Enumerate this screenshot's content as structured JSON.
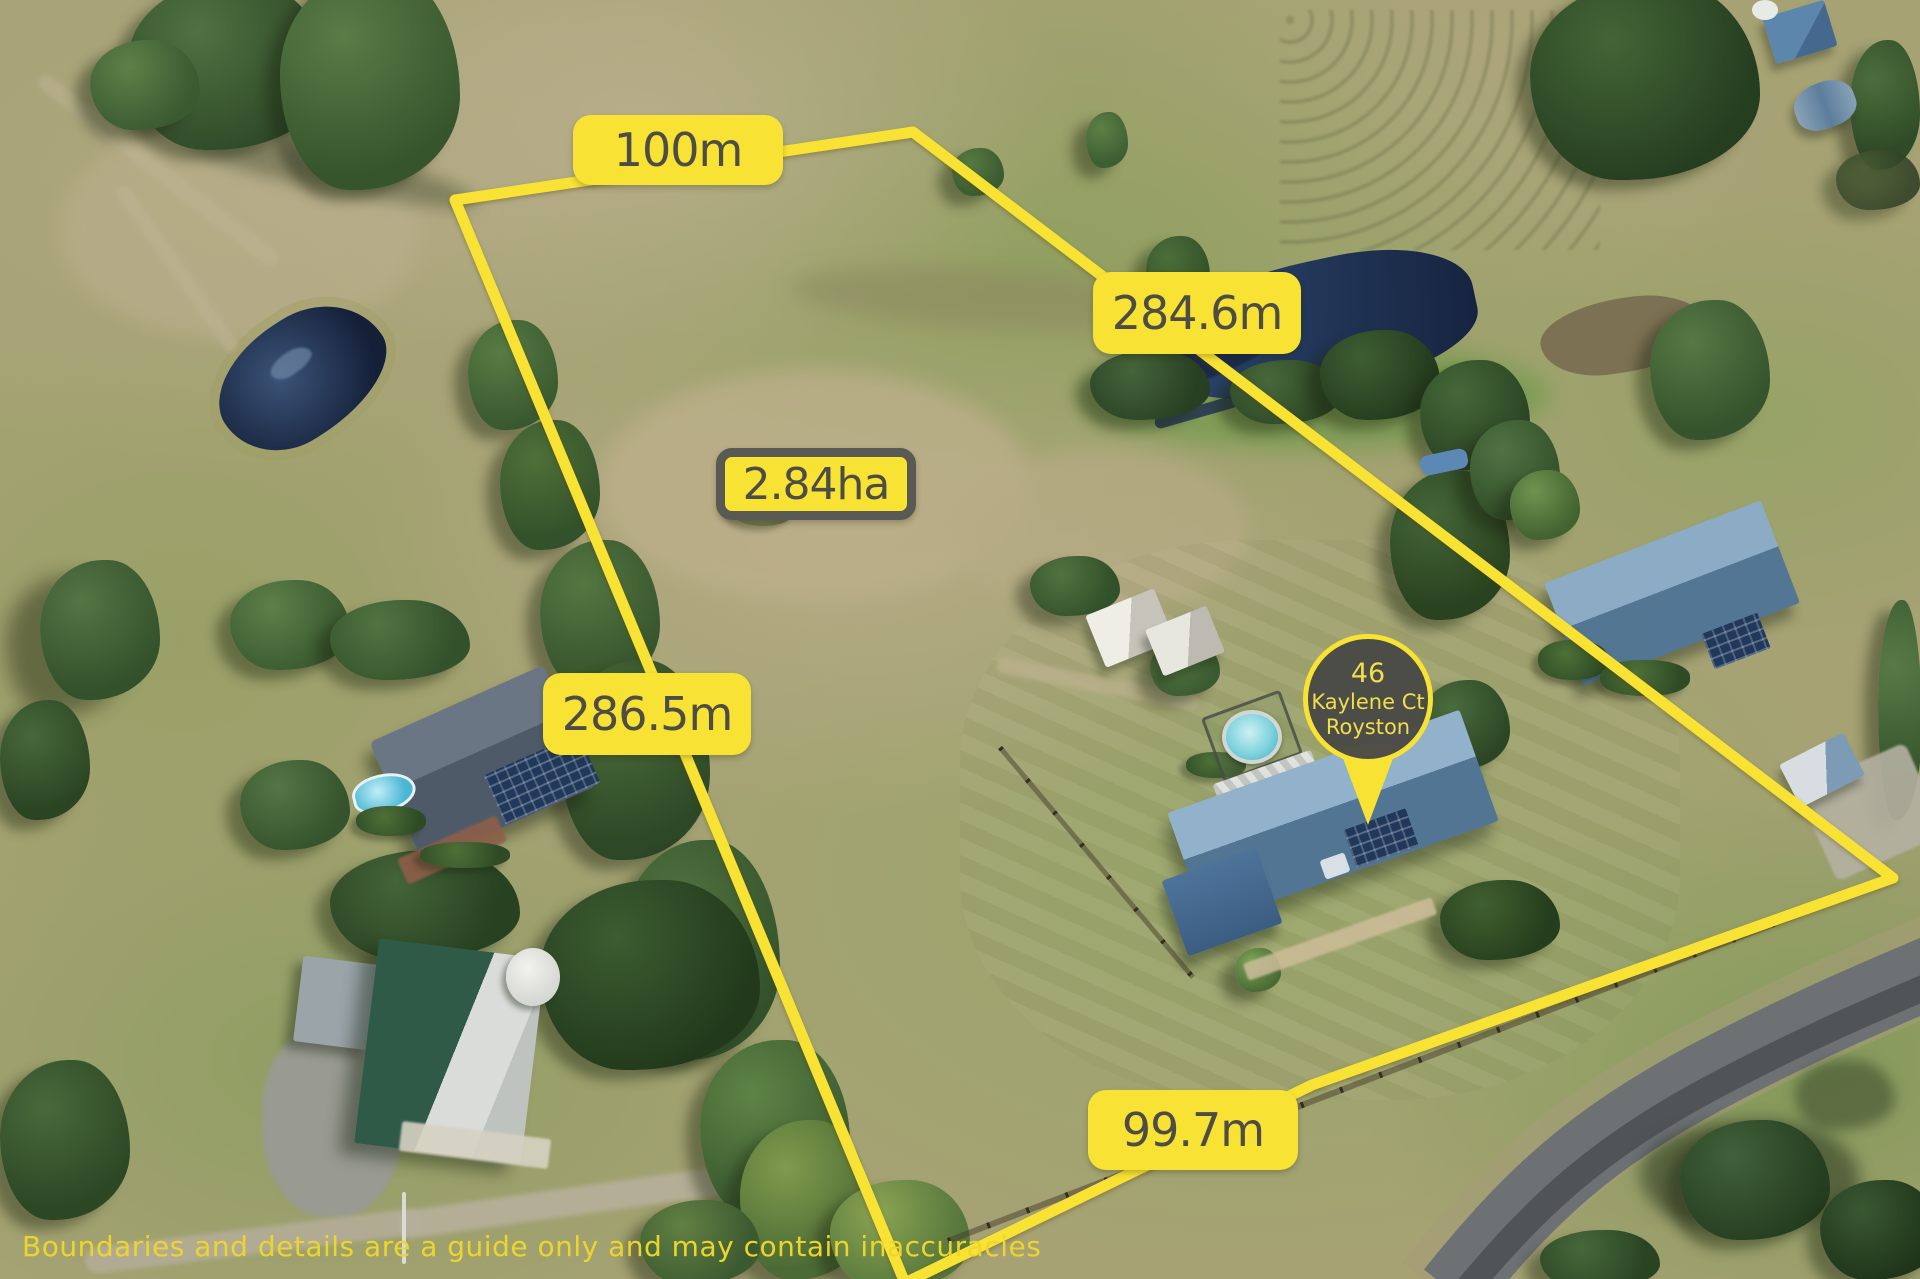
{
  "scene": {
    "description": "Aerial drone photograph of a rural acreage property with yellow boundary overlay, ponds, paddocks, houses, sheds and a road"
  },
  "overlay": {
    "boundary_lengths": {
      "top": "100m",
      "right": "284.6m",
      "left": "286.5m",
      "bottom": "99.7m"
    },
    "area_label": "2.84ha",
    "marker": {
      "street_number": "46",
      "street": "Kaylene Ct",
      "suburb": "Royston"
    },
    "disclaimer": "Boundaries and details are a guide only and may contain inaccuracies",
    "colors": {
      "boundary": "#F8E234",
      "label_bg": "#F8E234",
      "label_text": "#4D4D46",
      "area_border": "#5A5A55",
      "marker_bg": "#4A4A46",
      "marker_text": "#F2DE4D",
      "disclaimer_text": "#EDD52C"
    }
  }
}
